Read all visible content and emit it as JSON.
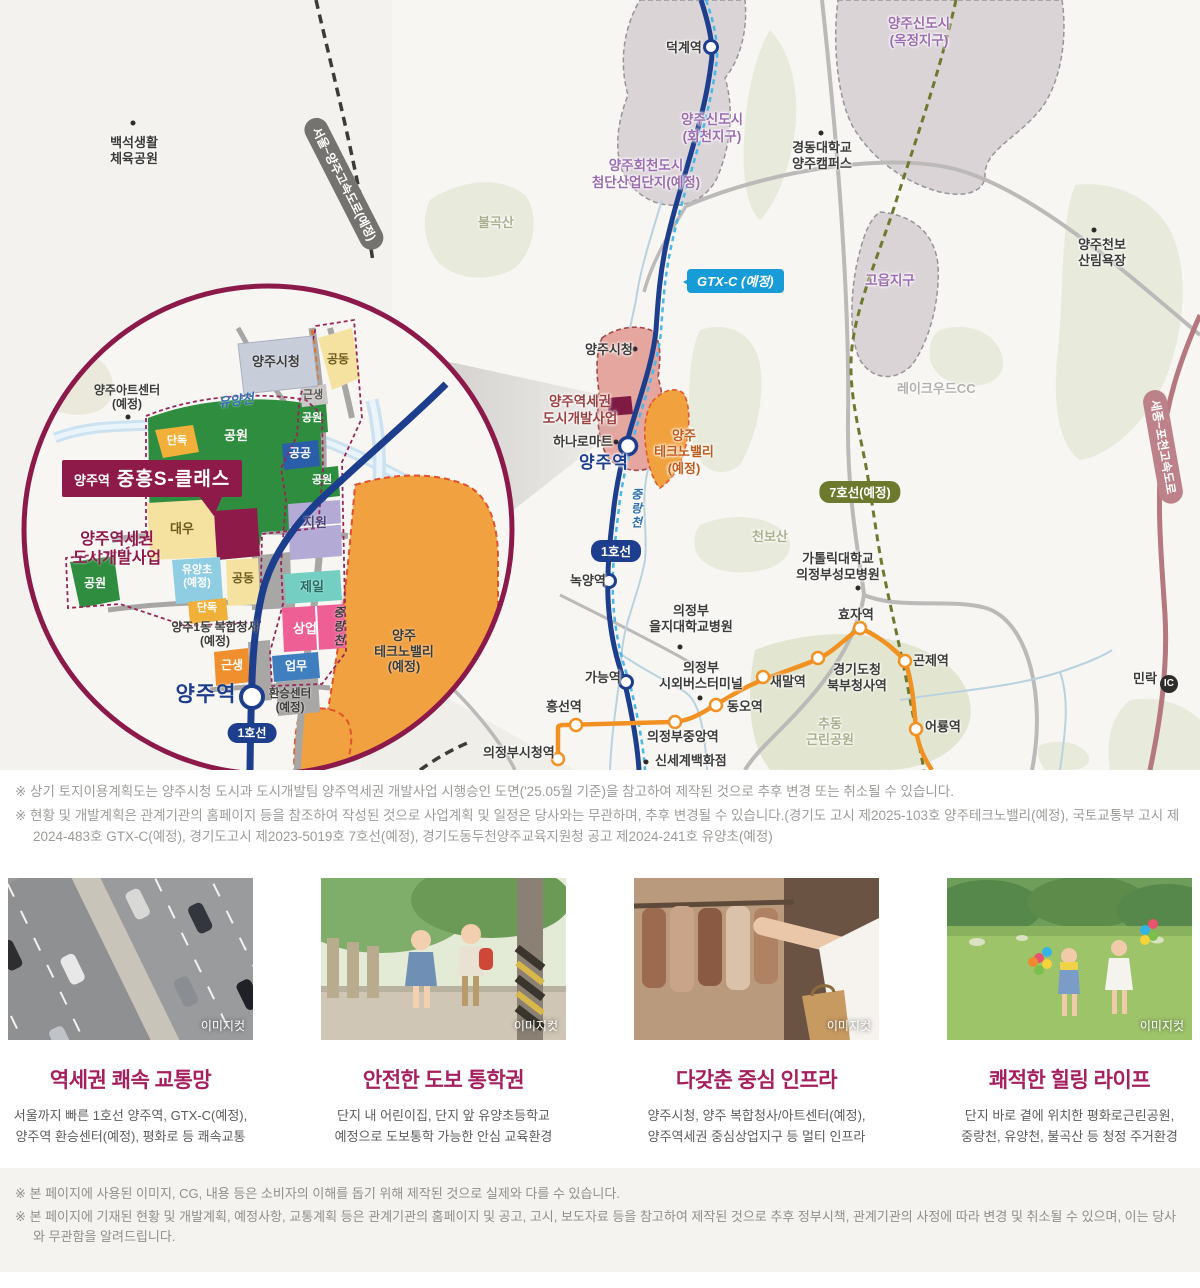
{
  "colors": {
    "brand": "#8e1a4a",
    "title_accent": "#a5205f",
    "line1": "#1d3e8c",
    "gtx": "#189cd8",
    "lrt": "#f19122",
    "line7": "#6d7a2e",
    "expressway": "#b4787e",
    "district_purple": "#9c6cb0"
  },
  "map": {
    "badges": {
      "gtx": "GTX-C (예정)",
      "line1": "1호선",
      "line7": "7호선(예정)",
      "seoul_yangju_expwy": "서울~양주고속도로(예정)",
      "sejong_pocheon_expwy": "세종~포천고속도로",
      "millak": "민락",
      "ic": "IC"
    },
    "regions": {
      "okjeong": "양주신도시\n(옥정지구)",
      "hoecheon": "양주신도시\n(회천지구)",
      "hoecheon_industrial": "양주회천도시\n첨단산업단지(예정)",
      "goeup": "고읍지구"
    },
    "stations": {
      "deokgye": "덕계역",
      "yangju": "양주역",
      "nokyang": "녹양역",
      "ganeung": "가능역",
      "heungseon": "흥선역",
      "uijeongbu_cityhall": "의정부시청역",
      "uijeongbu_jungang": "의정부중앙역",
      "dongo": "동오역",
      "saemal": "새말역",
      "gyeonggi_office": "경기도청\n북부청사역",
      "hyoja": "효자역",
      "gonje": "곤제역",
      "eoryong": "어룡역"
    },
    "places": {
      "baekseok_park": "백석생활\n체육공원",
      "bulgoksan": "불곡산",
      "kyungdong_univ": "경동대학교\n양주캠퍼스",
      "lakewood_cc": "레이크우드CC",
      "cheonbo_forest": "양주천보\n산림욕장",
      "yangju_cityhall": "양주시청",
      "hanaro_mart": "하나로마트",
      "dev_project": "양주역세권\n도시개발사업",
      "technovalley": "양주\n테크노밸리\n(예정)",
      "jungnangcheon": "중랑천",
      "cheonbosan": "천보산",
      "catholic_hospital": "가톨릭대학교\n의정부성모병원",
      "eulji_hospital": "의정부\n을지대학교병원",
      "bus_terminal": "의정부\n시외버스터미널",
      "chudong_park": "추동\n근린공원",
      "shinsegae": "신세계백화점"
    },
    "inset": {
      "site_prefix": "양주역",
      "site_name": "중흥S-클래스",
      "cityhall": "양주시청",
      "artcenter": "양주아트센터\n(예정)",
      "yuyangcheon": "유양천",
      "dev_project": "양주역세권\n도시개발사업",
      "station": "양주역",
      "line1": "1호선",
      "jungnangcheon": "중랑천",
      "technovalley": "양주\n테크노밸리\n(예정)",
      "complex_hall": "양주1동 복합청사\n(예정)",
      "transfer_center": "환승센터\n(예정)",
      "parcels": {
        "gongwon": "공원",
        "dandok": "단독",
        "gongdong": "공동",
        "geunsaeng": "근생",
        "gonggong": "공공",
        "jiwon": "지원",
        "daewoo": "대우",
        "yuyang_elem": "유양초\n(예정)",
        "jeil": "제일",
        "sangeop": "상업",
        "eopmu": "업무"
      }
    }
  },
  "notes_top": [
    "※ 상기 토지이용계획도는 양주시청 도시과 도시개발팀 양주역세권 개발사업 시행승인 도면('25.05월 기준)을 참고하여 제작된 것으로 추후 변경 또는 취소될 수 있습니다.",
    "※ 현황 및 개발계획은 관계기관의 홈페이지 등을 참조하여 작성된 것으로 사업계획 및 일정은 당사와는 무관하며, 추후 변경될 수 있습니다.(경기도 고시 제2025-103호 양주테크노밸리(예정), 국토교통부 고시 제2024-483호 GTX-C(예정), 경기도고시 제2023-5019호 7호선(예정), 경기도동두천양주교육지원청 공고 제2024-241호 유양초(예정)"
  ],
  "cards": [
    {
      "tag": "이미지컷",
      "title": "역세권 쾌속 교통망",
      "body": "서울까지 빠른 1호선 양주역, GTX-C(예정),\n양주역 환승센터(예정), 평화로 등 쾌속교통"
    },
    {
      "tag": "이미지컷",
      "title": "안전한 도보 통학권",
      "body": "단지 내 어린이집, 단지 앞 유양초등학교\n예정으로 도보통학 가능한 안심 교육환경"
    },
    {
      "tag": "이미지컷",
      "title": "다갖춘 중심 인프라",
      "body": "양주시청, 양주 복합청사/아트센터(예정),\n양주역세권 중심상업지구 등 멀티 인프라"
    },
    {
      "tag": "이미지컷",
      "title": "쾌적한 힐링 라이프",
      "body": "단지 바로 곁에 위치한 평화로근린공원,\n중랑천, 유양천, 불곡산 등 청정 주거환경"
    }
  ],
  "notes_bottom": [
    "※ 본 페이지에 사용된 이미지, CG, 내용 등은 소비자의 이해를 돕기 위해 제작된 것으로 실제와 다를 수 있습니다.",
    "※ 본 페이지에 기재된 현황 및 개발계획, 예정사항, 교통계획 등은 관계기관의 홈페이지 및 공고, 고시, 보도자료 등을 참고하여 제작된 것으로 추후 정부시책, 관계기관의 사정에 따라 변경 및 취소될 수 있으며, 이는 당사와 무관함을 알려드립니다."
  ]
}
